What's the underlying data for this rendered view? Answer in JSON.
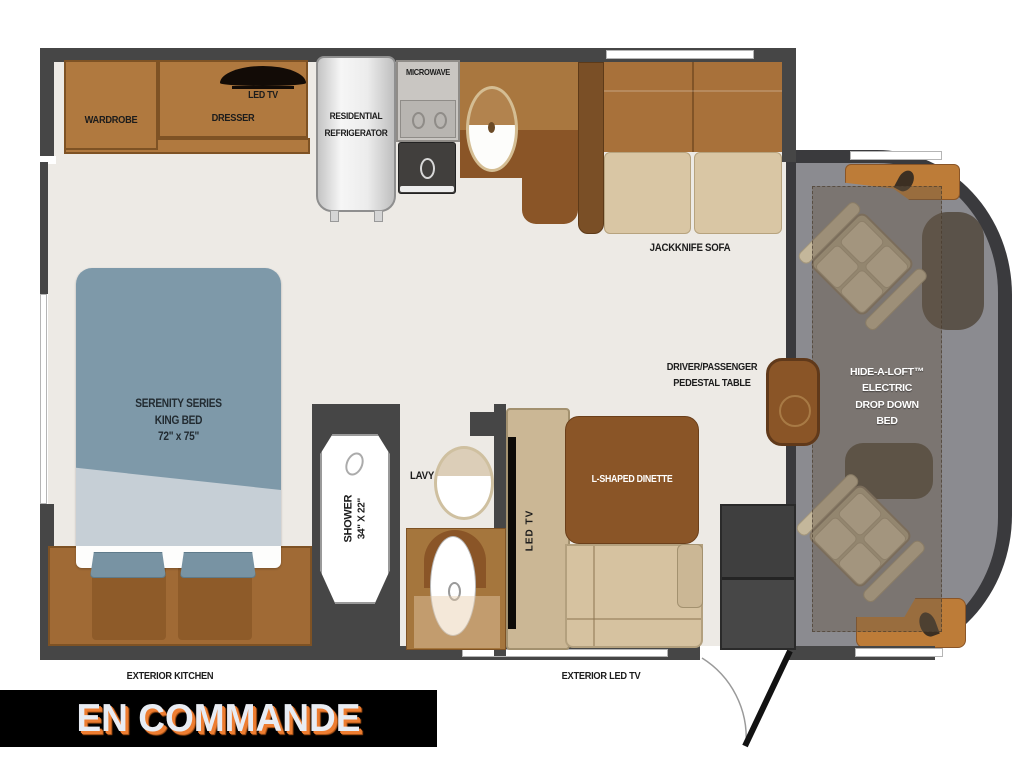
{
  "floorplan": {
    "bedroom": {
      "wardrobe": "WARDROBE",
      "dresser": "DRESSER",
      "led_tv": "LED TV",
      "bed_lines": [
        "SERENITY SERIES",
        "KING BED",
        "72\" x 75\""
      ]
    },
    "kitchen": {
      "refrigerator_lines": [
        "RESIDENTIAL",
        "REFRIGERATOR"
      ],
      "microwave": "MICROWAVE"
    },
    "living": {
      "sofa": "JACKKNIFE SOFA",
      "dinette": "L-SHAPED DINETTE",
      "dinette_tv": "LED TV",
      "pedestal_lines": [
        "DRIVER/PASSENGER",
        "PEDESTAL TABLE"
      ]
    },
    "bathroom": {
      "shower_lines": [
        "SHOWER",
        "34\" X 22\""
      ],
      "lavy": "LAVY"
    },
    "cab": {
      "loft_lines": [
        "HIDE-A-LOFT™",
        "ELECTRIC",
        "DROP DOWN",
        "BED"
      ]
    },
    "exterior": {
      "kitchen": "EXTERIOR KITCHEN",
      "led_tv": "EXTERIOR LED TV"
    }
  },
  "banner": {
    "text": "EN COMMANDE",
    "bg_color": "#000000",
    "text_color": "#e8ecf3",
    "shadow_color": "#ed7d31"
  },
  "colors": {
    "wall": "#464646",
    "floor": "#edeae5",
    "wood": "#b0793f",
    "wood_dark": "#8a5527",
    "bed_blue": "#7e99a9",
    "cushion_tan": "#d9c6a4",
    "cab_gray": "#8b8b90"
  }
}
